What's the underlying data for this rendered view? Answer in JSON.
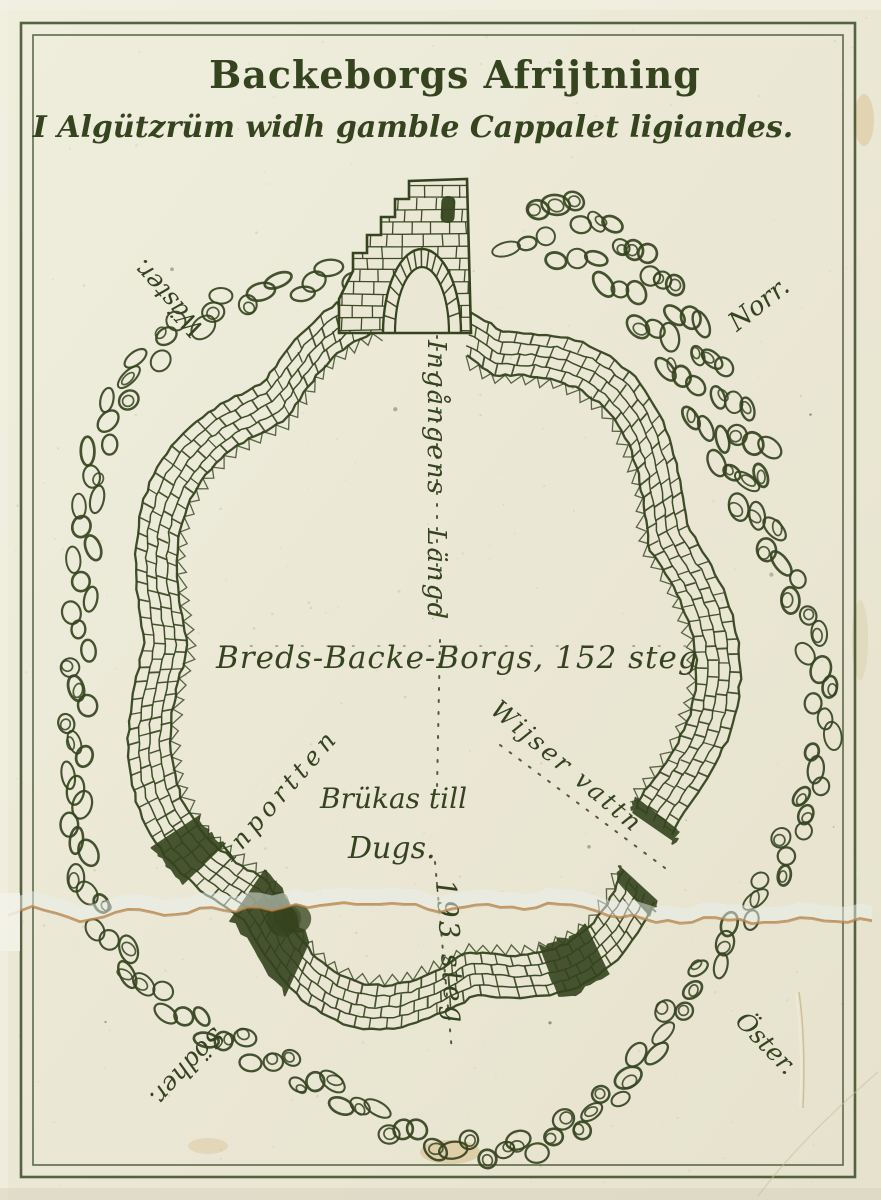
{
  "titles": {
    "line1": "Backeborgs Afrijtning",
    "line2": "I Algützrüm widh gamble Cappalet ligiandes."
  },
  "compass": {
    "west": "Wäster.",
    "north": "Norr.",
    "south": "Södher.",
    "east": "Öster."
  },
  "annotations": {
    "entrance_length": "Ingångens Längd",
    "breadth": "Breds-Backe-Borgs, 152 steg",
    "inner_gate": "Inportten",
    "water_note": "Wijser vattn",
    "usage_line1": "Brükas till",
    "usage_line2": "Dugs.",
    "diagonal_length": "193 steg"
  },
  "colors": {
    "ink": "#35441f",
    "paper": "#eae7d5",
    "paper_light": "#f4f2e4",
    "tear": "#bd8a4e",
    "stain": "#d2a968"
  }
}
